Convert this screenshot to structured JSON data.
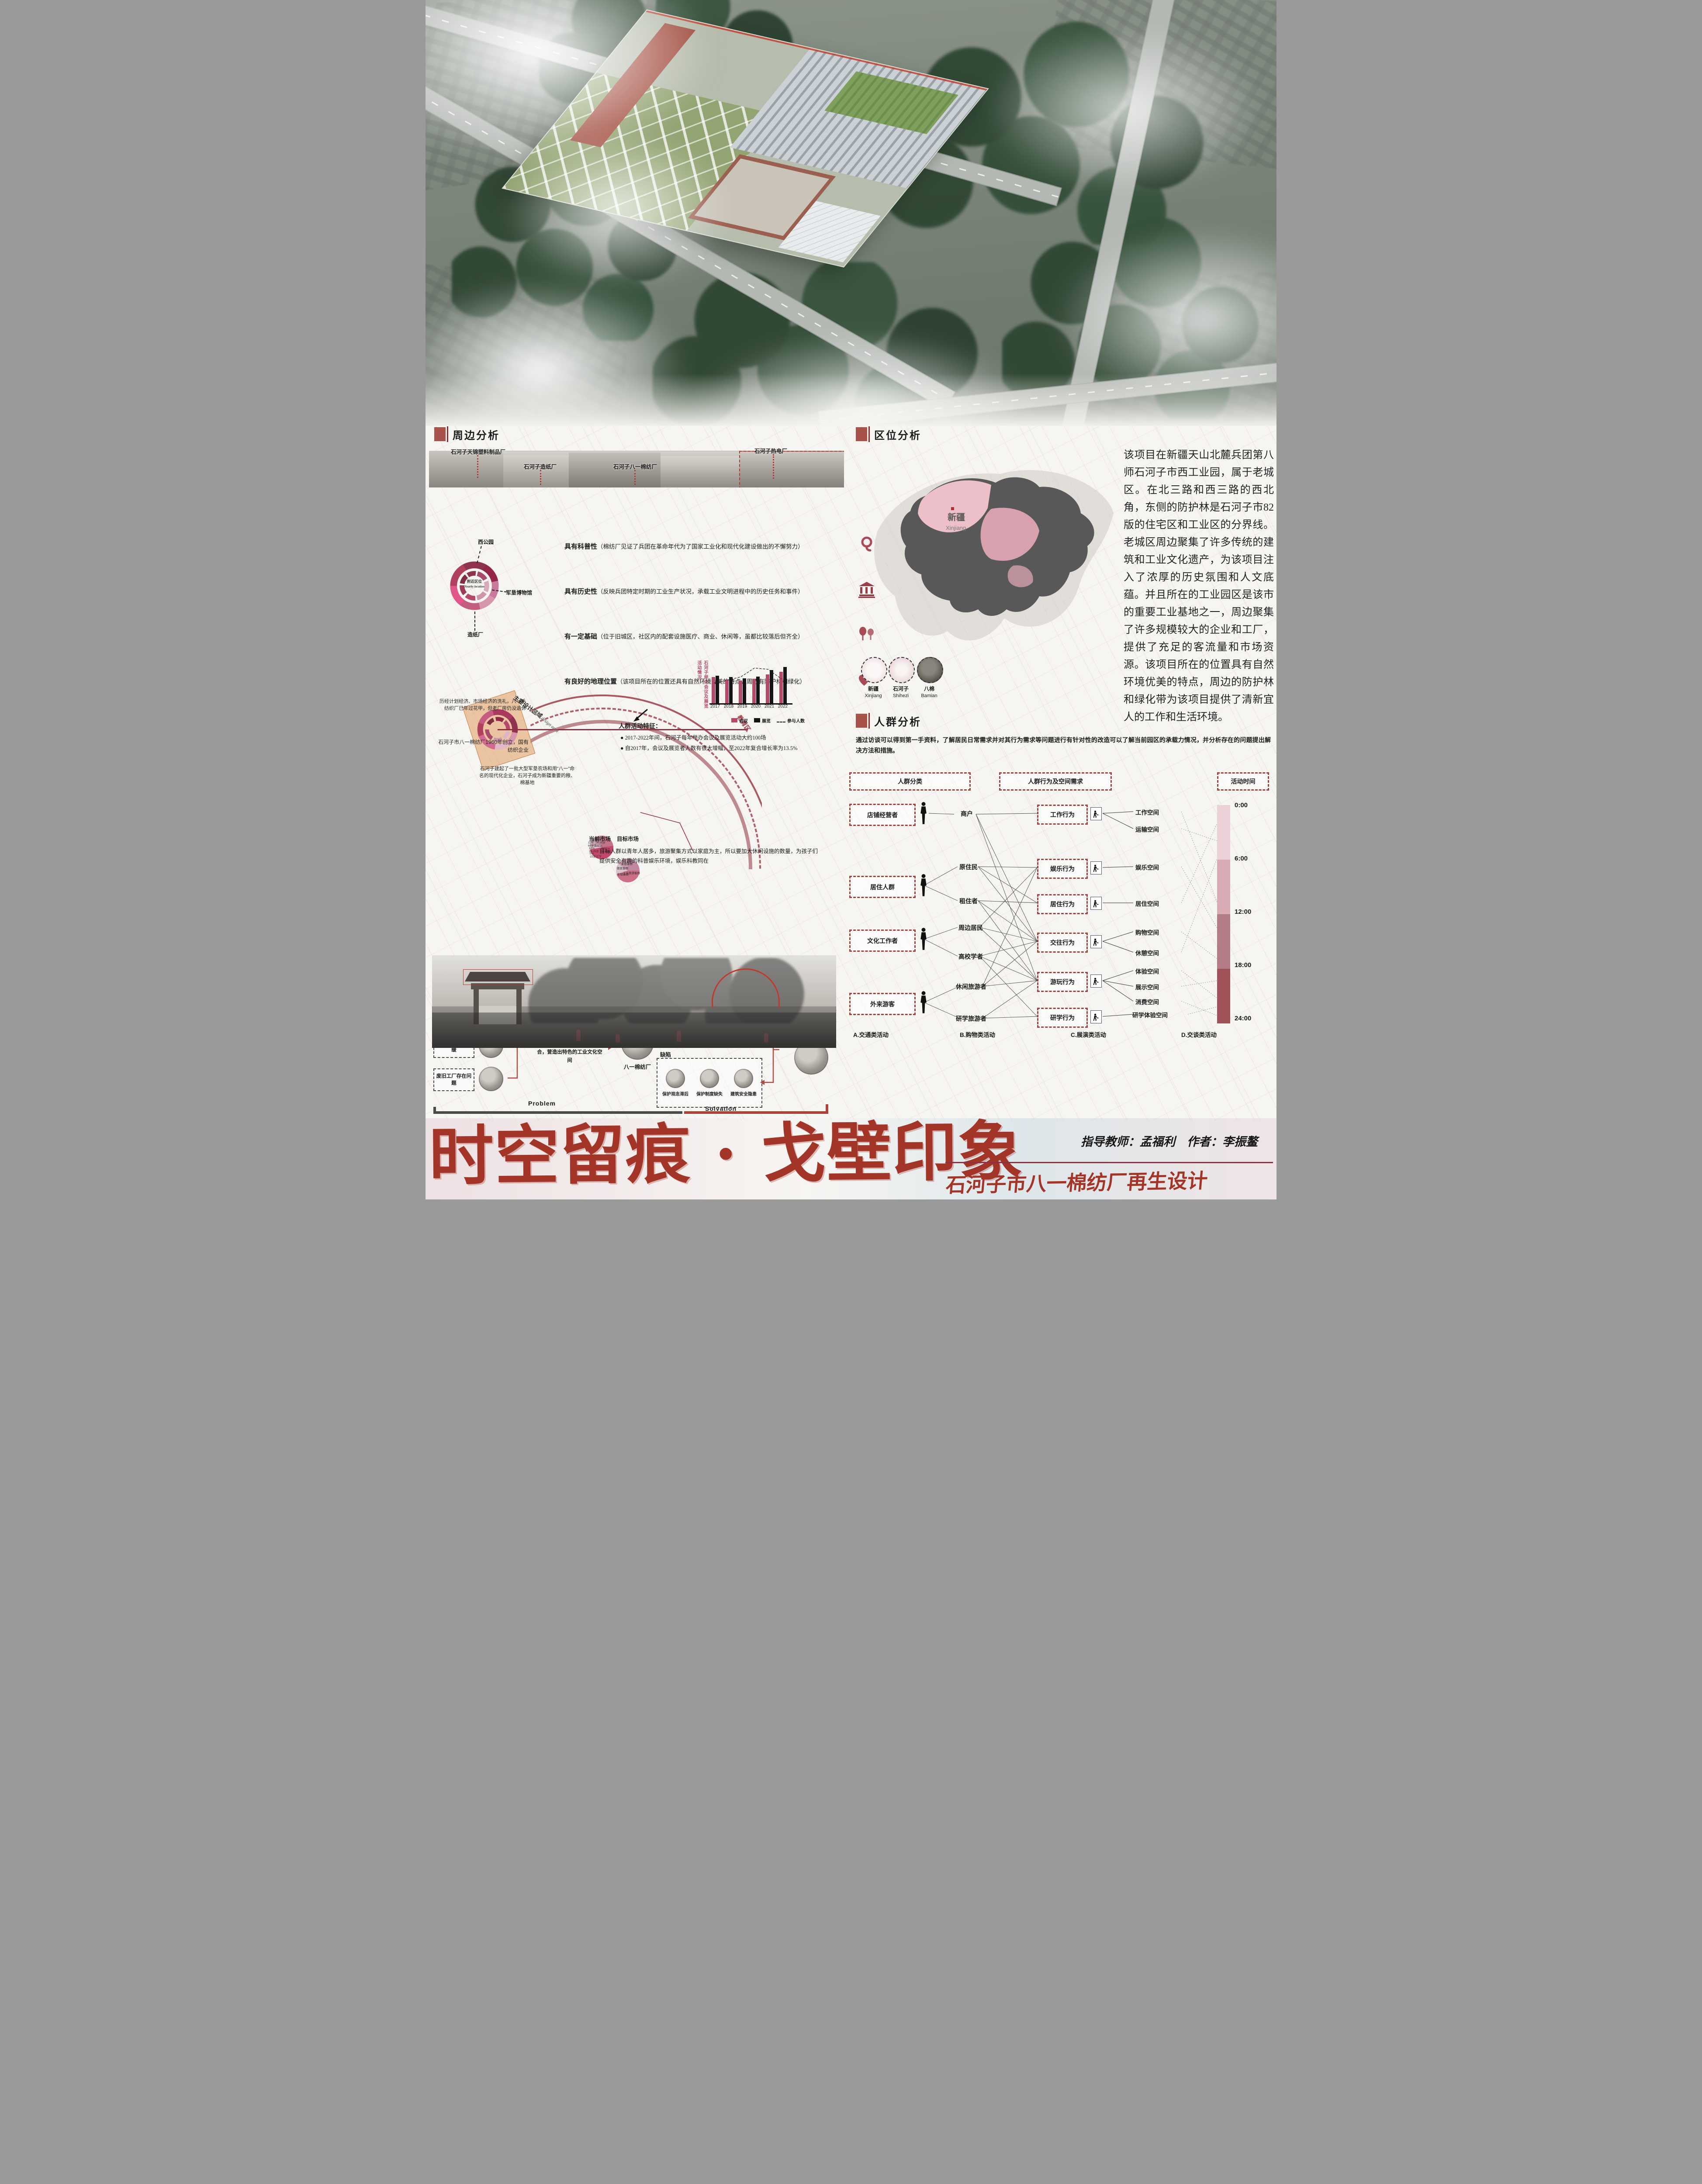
{
  "poster": {
    "title": "时空留痕 · 戈壁印象",
    "subtitle": "石河子市八一棉纺厂再生设计",
    "credit_advisor": "指导教师：孟福利",
    "credit_author": "作者：李振鳌",
    "accent_color": "#a8524a",
    "deep_red": "#8e3140"
  },
  "surrounding": {
    "title": "周边分析",
    "factories": [
      "石河子天锦塑料制品厂",
      "石河子造纸厂",
      "石河子八一棉纺厂",
      "石河子热电厂"
    ],
    "bullets": [
      {
        "title": "具有科普性",
        "desc": "（棉纺厂见证了兵团在革命年代为了国家工业化和现代化建设做出的不懈努力）",
        "icon": "yarn-icon"
      },
      {
        "title": "具有历史性",
        "desc": "（反映兵团特定时期的工业生产状况，承载工业文明进程中的历史任务和事件）",
        "icon": "museum-icon"
      },
      {
        "title": "有一定基础",
        "desc": "（位于旧城区，社区内的配套设施医疗、商业、休闲等，虽都比较落后但齐全）",
        "icon": "trees-icon"
      },
      {
        "title": "有良好的地理位置",
        "desc": "（该项目所在的位置还具有自然环境优美的特点，周边有防护林和绿化）",
        "icon": "heart-pin-icon"
      }
    ],
    "ring": {
      "center_cn": "附近区位",
      "center_en": "Nearby location",
      "callouts": [
        "西公园",
        "军垦博物馆",
        "造纸厂"
      ]
    },
    "main_area_cn": "主要设计区域",
    "main_area_en": "Main design area",
    "arc_label": "教育区",
    "notes": [
      "历经计划经济、市场经济的洗礼，八一毛纺织厂已年过花甲，但老厂房仍没退休",
      "石河子市八一棉纺厂1960年创立，国有纺织企业",
      "石河子建起了一批大型军垦农场和用“八一”命名的现代化企业，石河子成为新疆重要的粮、棉基地"
    ],
    "activity_heading": "人群活动特征：",
    "activity_bullets": [
      "● 2017-2022年间，石河子每年举办会议及展览活动大约100场",
      "● 自2017年，会议及展览者人数有很大增幅，至2022年复合增长率为13.5%"
    ],
    "market_note": "目标人群以青年人居多，旅游聚集方式以家庭为主，所以要加大休闲设施的数量，为孩子们提供安全有趣的科普娱乐环境，娱乐科教同在"
  },
  "location": {
    "title": "区位分析",
    "map_cn": "新疆",
    "map_en": "Xinjiang",
    "paragraph": "该项目在新疆天山北麓兵团第八师石河子市西工业园，属于老城区。在北三路和西三路的西北角，东侧的防护林是石河子市82版的住宅区和工业区的分界线。老城区周边聚集了许多传统的建筑和工业文化遗产，为该项目注入了浓厚的历史氛围和人文底蕴。并且所在的工业园区是该市的重要工业基地之一，周边聚集了许多规模较大的企业和工厂，提供了充足的客流量和市场资源。该项目所在的位置具有自然环境优美的特点，周边的防护林和绿化带为该项目提供了清新宜人的工作和生活环境。",
    "circles": [
      {
        "cn": "新疆",
        "en": "Xinjiang"
      },
      {
        "cn": "石河子",
        "en": "Shihezi"
      },
      {
        "cn": "八棉",
        "en": "Bamian"
      }
    ]
  },
  "crowd": {
    "title": "人群分析",
    "paragraph": "通过访谈可以得到第一手资料，了解居民日常需求并对其行为需求等问题进行有针对性的改造可以了解当前园区的承载力情况，并分析存在的问题提出解决方法和措施。",
    "headers": [
      "人群分类",
      "人群行为及空间需求",
      "活动时间"
    ],
    "groups": [
      "店铺经营者",
      "居住人群",
      "文化工作者",
      "外来游客"
    ],
    "roles": [
      "商户",
      "原住民",
      "租住者",
      "周边居民",
      "高校学者",
      "休闲旅游者",
      "研学旅游者"
    ],
    "behaviors": [
      "工作行为",
      "娱乐行为",
      "居住行为",
      "交往行为",
      "游玩行为",
      "研学行为"
    ],
    "spaces": [
      "工作空间",
      "运输空间",
      "娱乐空间",
      "居住空间",
      "购物空间",
      "休憩空间",
      "体验空间",
      "展示空间",
      "消费空间",
      "研学体验空间"
    ],
    "timeline": {
      "labels": [
        "0:00",
        "6:00",
        "12:00",
        "18:00",
        "24:00"
      ],
      "colors": [
        "#ead2d8",
        "#d9abb5",
        "#b27c84",
        "#a05258"
      ]
    }
  },
  "activities": {
    "labels": [
      "A.交通类活动",
      "B.购物类活动",
      "C.展演类活动",
      "D.交谈类活动"
    ]
  },
  "background": {
    "title": "设计背景",
    "problems": [
      "“退二进三”政策推行",
      "当地经济发展滞缓",
      "废旧工厂存在问题"
    ],
    "mid_text": "废旧工厂亟待改革，其活化需将工业文化与使用功能相结合，营造出特色的工业文化空间",
    "factory_label": "八一棉纺厂",
    "strengths_label": "优势",
    "strengths": [
      "区位条件优越",
      "政策导向",
      "工业文化历史悠久"
    ],
    "weaknesses_label": "缺陷",
    "weaknesses": [
      "保护观念滞后",
      "保护制度缺失",
      "建筑安全隐患"
    ],
    "solution_text": "融合工业文化基因，对厂房及周边地块环境进行再设计",
    "problem_label": "Problem",
    "solvation_label": "Solvation"
  },
  "chart_data": [
    {
      "type": "bar",
      "title": "石河子举办会议及展览活动情况",
      "categories": [
        "2017",
        "2018",
        "2019",
        "2020",
        "2021",
        "2022"
      ],
      "series": [
        {
          "name": "会议",
          "values": [
            63,
            56,
            54,
            58,
            69,
            75
          ]
        },
        {
          "name": "展览",
          "values": [
            66,
            62,
            59,
            64,
            79,
            86
          ]
        },
        {
          "name": "参与人数",
          "style": "dashed-line",
          "values": [
            48,
            55,
            63,
            84,
            81,
            58
          ]
        }
      ],
      "colors": [
        "#b5496b",
        "#141414"
      ],
      "ylim": [
        0,
        100
      ],
      "legend_position": "bottom"
    },
    {
      "type": "pie",
      "title": "当前市场",
      "slices": [
        {
          "label": "26-35岁",
          "value": 23,
          "pct": "23%"
        },
        {
          "label": "36-60岁",
          "value": 49,
          "pct": "49%"
        },
        {
          "label": "15岁以下",
          "value": 5,
          "pct": "5%"
        },
        {
          "label": "16-25岁",
          "value": 12,
          "pct": "12%"
        },
        {
          "label": "60岁及以上",
          "value": 11,
          "pct": "11%"
        }
      ],
      "colors": [
        "#c17489",
        "#c4476b",
        "#dcc3cb",
        "#cda4b4",
        "#c58ba0"
      ]
    },
    {
      "type": "pie",
      "title": "目标市场",
      "slices": [
        {
          "label": "家庭客群",
          "value": 25
        },
        {
          "label": "工业旅游客群",
          "value": 45
        },
        {
          "label": "年轻客群",
          "value": 15
        },
        {
          "label": "银发客群",
          "value": 15
        }
      ],
      "colors": [
        "#c287a0",
        "#cc6e86",
        "#d8c3cb",
        "#c99bad"
      ]
    }
  ]
}
